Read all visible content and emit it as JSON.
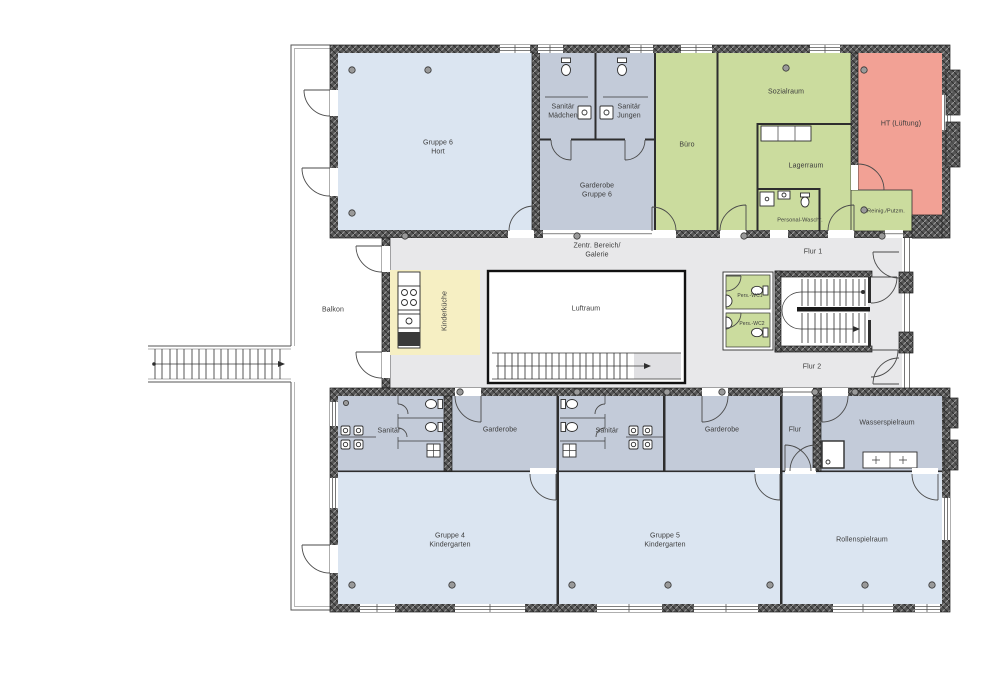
{
  "plan": {
    "kind": "floor-plan",
    "language": "de"
  },
  "colors": {
    "room_lightblue": "#dbe5f1",
    "room_grayblue": "#c3cbd9",
    "room_green": "#cbdc9e",
    "room_red": "#f2a195",
    "room_yellow": "#f6efc3",
    "corridor": "#e8e8ea",
    "stair_gray": "#e0e0e3",
    "wall_dark": "#565656"
  },
  "rooms": {
    "gruppe6": {
      "name": "Gruppe 6",
      "type": "Hort"
    },
    "sanitaer_maedchen": {
      "name": "Sanitär",
      "type": "Mädchen"
    },
    "sanitaer_jungen": {
      "name": "Sanitär",
      "type": "Jungen"
    },
    "garderobe_gruppe6": {
      "name": "Garderobe",
      "type": "Gruppe 6"
    },
    "buero": {
      "name": "Büro"
    },
    "sozialraum": {
      "name": "Sozialraum"
    },
    "lagerraum": {
      "name": "Lagerraum"
    },
    "personal_waschraum": {
      "name": "Personal-Waschr."
    },
    "reinigung_putzm": {
      "name": "Reinig./Putzm."
    },
    "ht_lueftung": {
      "name": "HT (Lüftung)"
    },
    "flur1": {
      "name": "Flur 1"
    },
    "zentraler_bereich": {
      "name": "Zentr. Bereich/",
      "type": "Galerie"
    },
    "balkon": {
      "name": "Balkon"
    },
    "kinderkueche": {
      "name": "Kinderküche"
    },
    "luftraum": {
      "name": "Luftraum"
    },
    "pers_wc1": {
      "name": "Pers.-WC1"
    },
    "pers_wc2": {
      "name": "Pers.-WC2"
    },
    "flur2": {
      "name": "Flur 2"
    },
    "sanitaer_links": {
      "name": "Sanitär"
    },
    "garderobe_links": {
      "name": "Garderobe"
    },
    "sanitaer_rechts": {
      "name": "Sanitär"
    },
    "garderobe_rechts": {
      "name": "Garderobe"
    },
    "flur": {
      "name": "Flur"
    },
    "wasserspielraum": {
      "name": "Wasserspielraum"
    },
    "gruppe4": {
      "name": "Gruppe 4",
      "type": "Kindergarten"
    },
    "gruppe5": {
      "name": "Gruppe 5",
      "type": "Kindergarten"
    },
    "rollenspielraum": {
      "name": "Rollenspielraum"
    }
  }
}
